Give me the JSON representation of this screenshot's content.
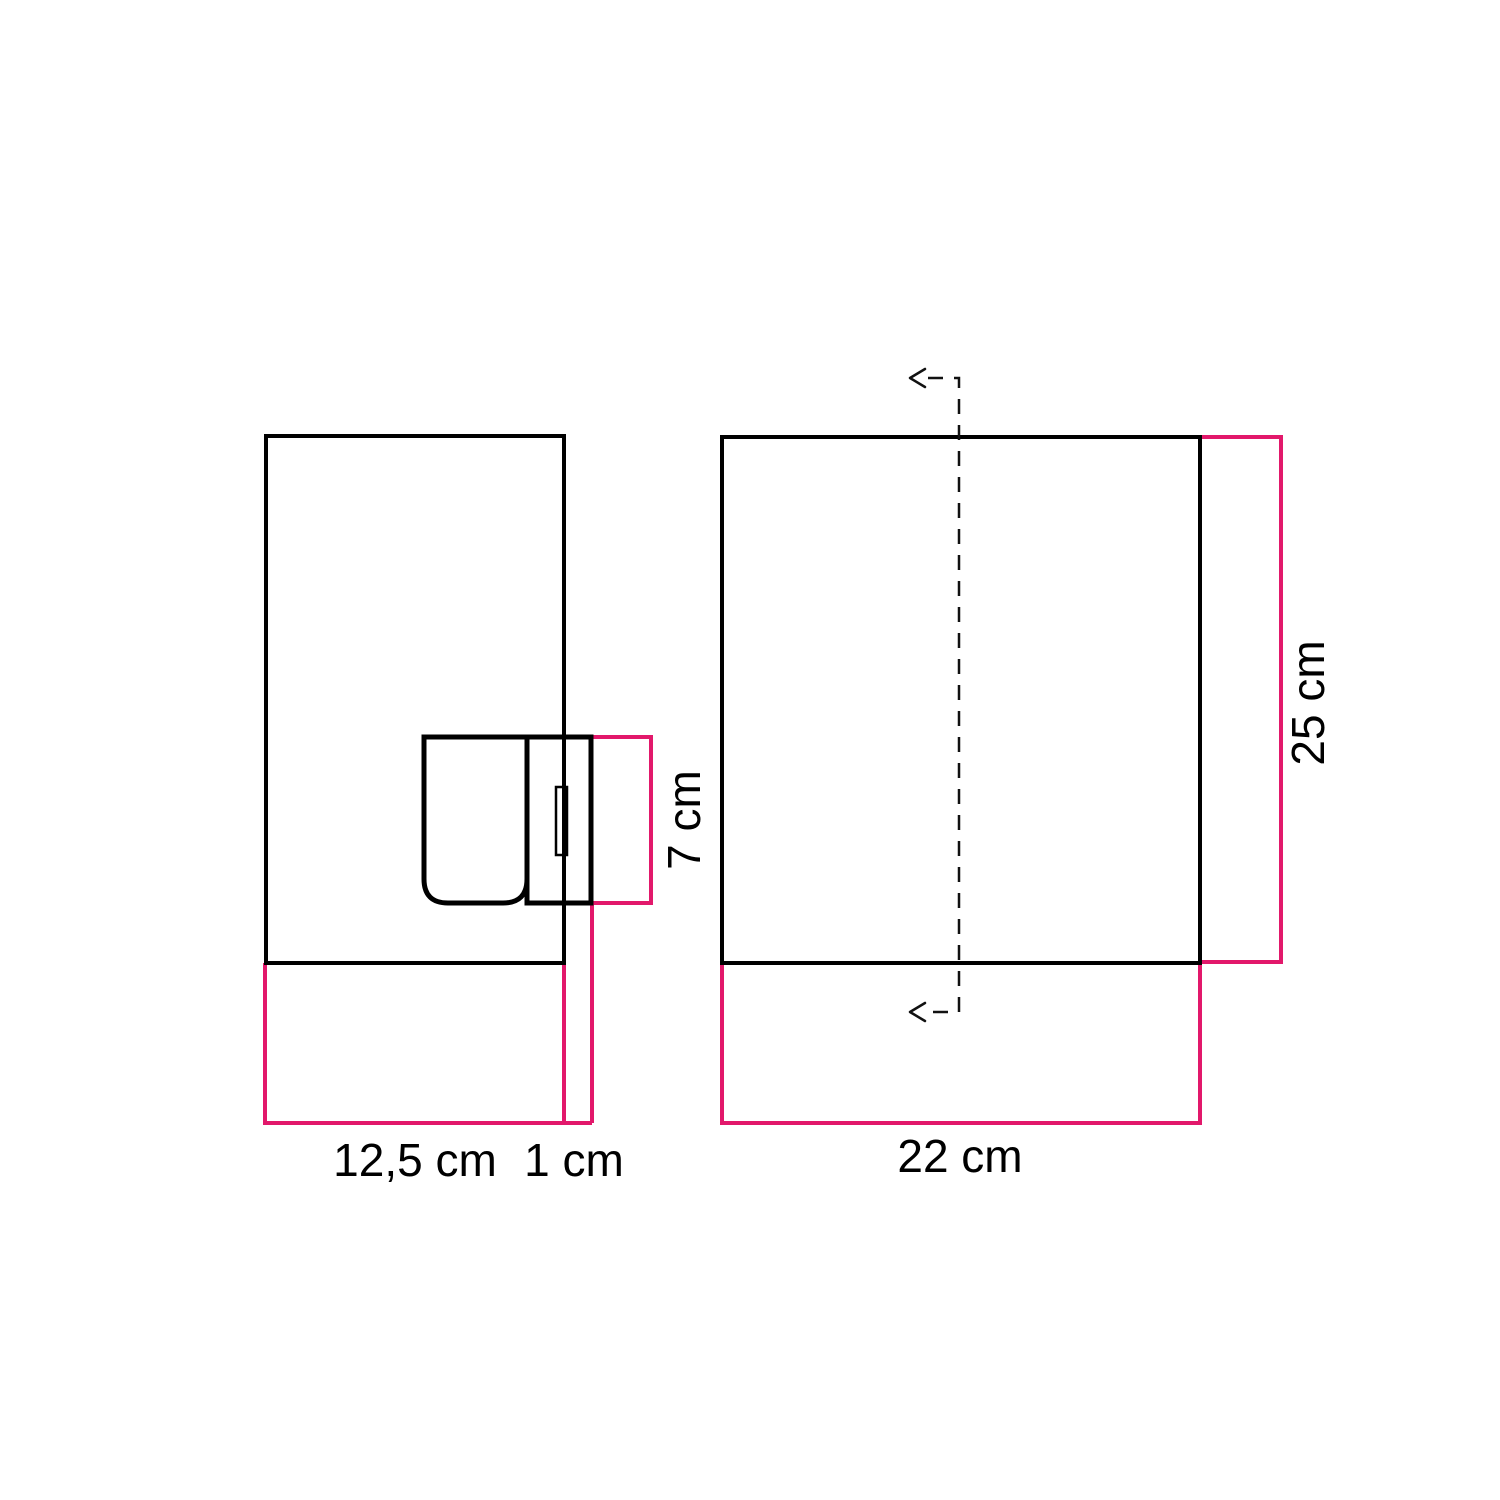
{
  "diagram": {
    "type": "product-dimension-drawing",
    "views": {
      "side_view": "wall lamp side profile with box shade, lamp holder and mounting plate",
      "front_view": "box shade front with dashed center axis and direction arrows"
    },
    "labels": {
      "side_width": "12,5 cm",
      "plate_offset": "1 cm",
      "socket_height": "7 cm",
      "front_width": "22 cm",
      "front_height": "25 cm"
    },
    "colors": {
      "outline": "#000000",
      "dimension": "#e2186b",
      "centerline": "#111111",
      "background": "#ffffff"
    }
  }
}
